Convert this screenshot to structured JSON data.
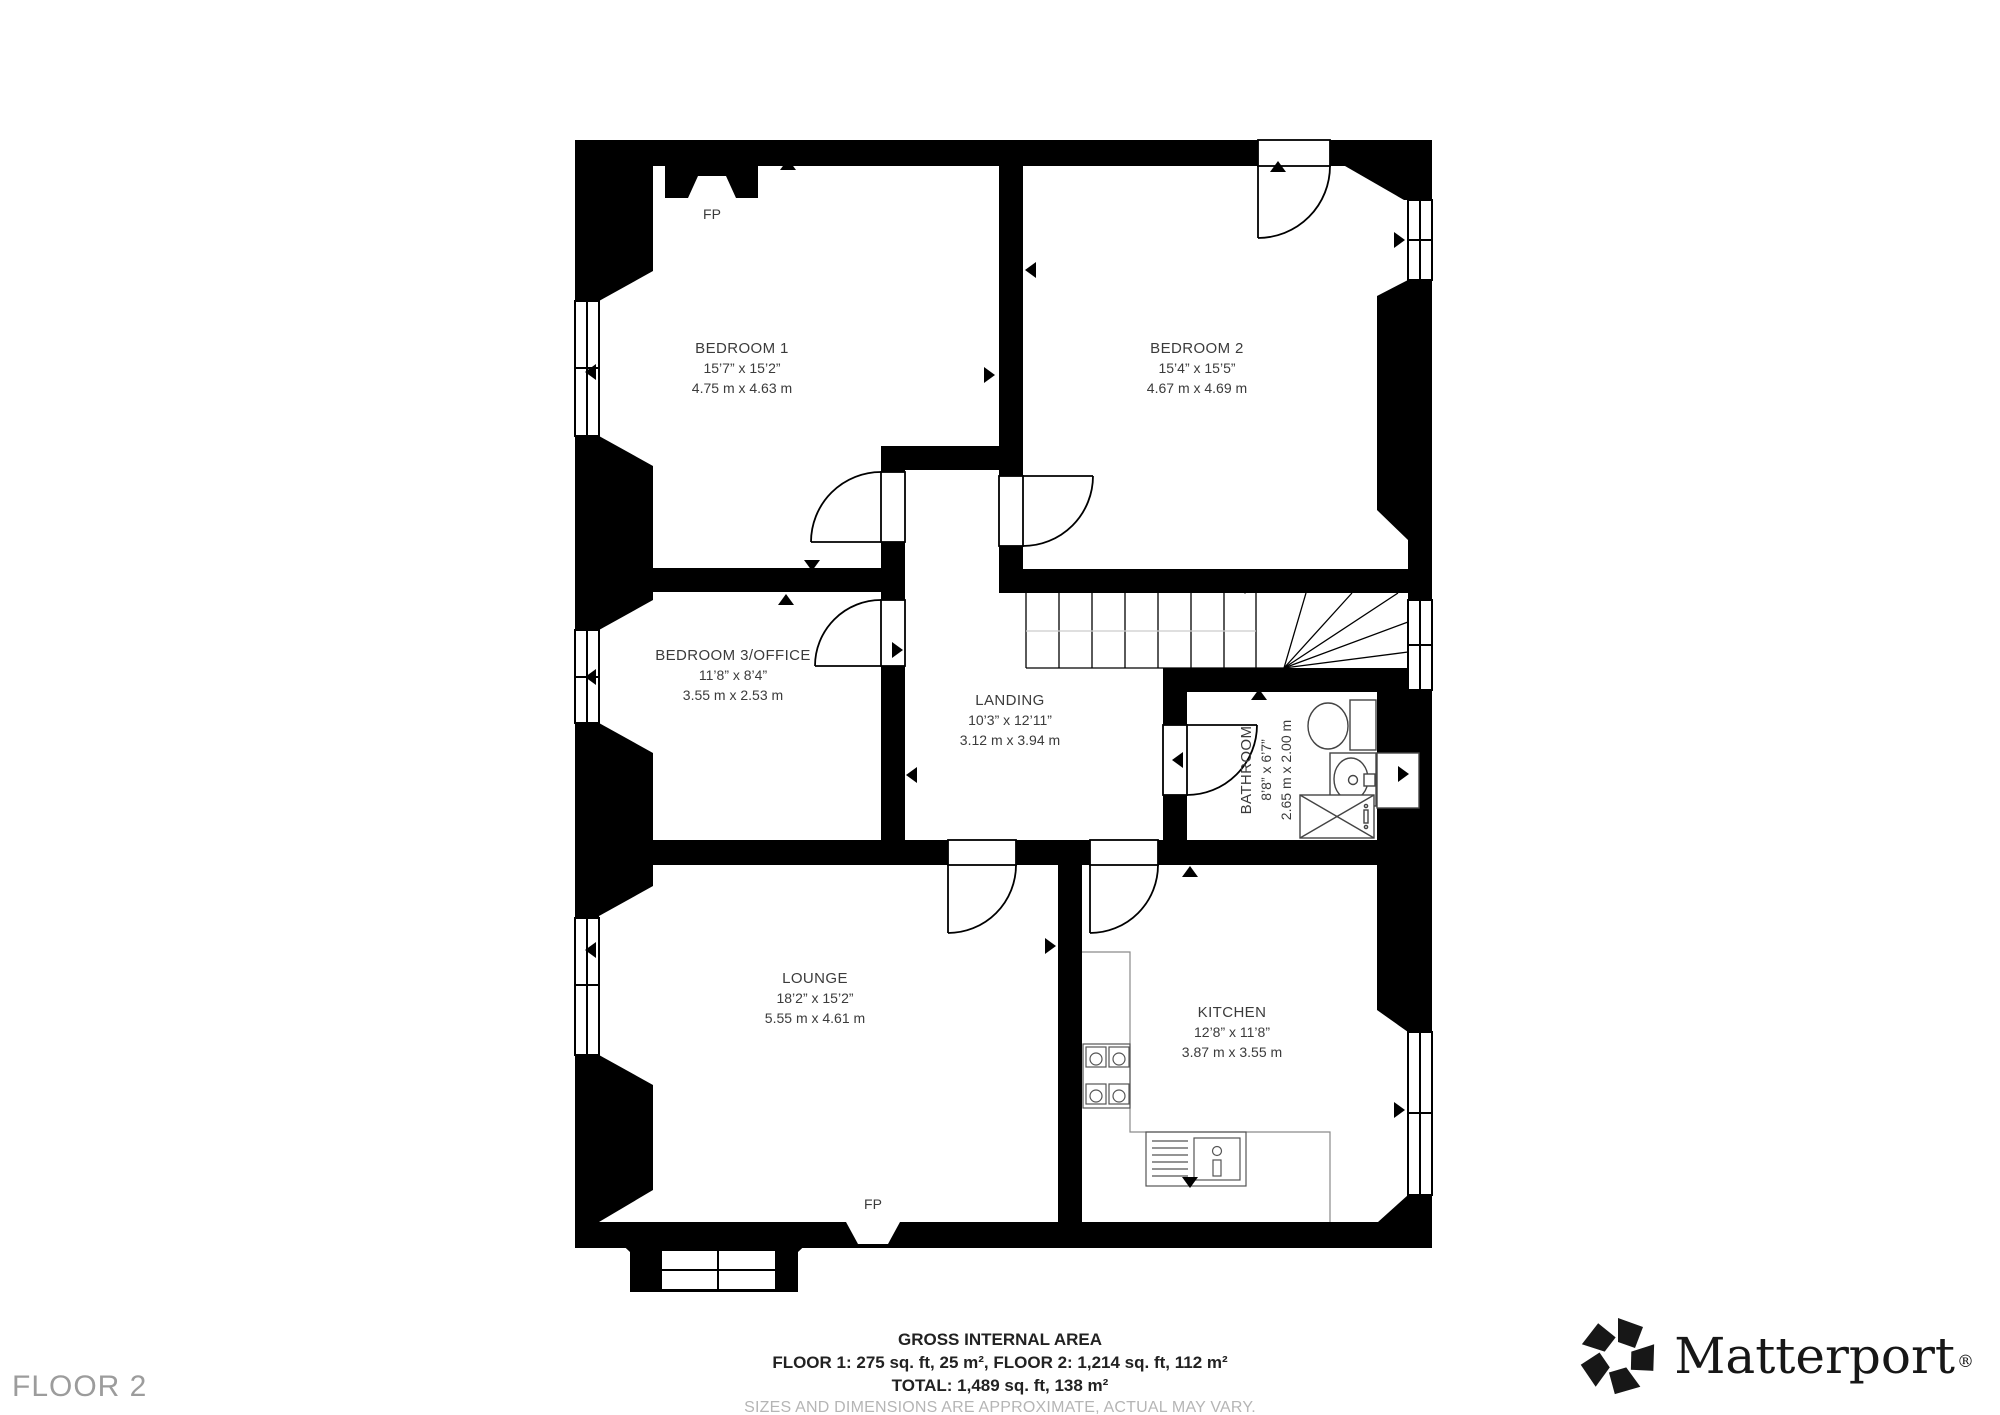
{
  "floor_label": "FLOOR 2",
  "rooms": [
    {
      "id": "bedroom1",
      "name": "BEDROOM 1",
      "imperial": "15’7” x 15’2”",
      "metric": "4.75 m x 4.63 m"
    },
    {
      "id": "bedroom2",
      "name": "BEDROOM 2",
      "imperial": "15’4” x 15’5”",
      "metric": "4.67 m x 4.69 m"
    },
    {
      "id": "bedroom3",
      "name": "BEDROOM 3/OFFICE",
      "imperial": "11’8” x 8’4”",
      "metric": "3.55 m x 2.53 m"
    },
    {
      "id": "landing",
      "name": "LANDING",
      "imperial": "10’3” x 12’11”",
      "metric": "3.12 m x 3.94 m"
    },
    {
      "id": "bathroom",
      "name": "BATHROOM",
      "imperial": "8’8” x 6’7”",
      "metric": "2.65 m x 2.00 m"
    },
    {
      "id": "lounge",
      "name": "LOUNGE",
      "imperial": "18’2” x 15’2”",
      "metric": "5.55 m x 4.61 m"
    },
    {
      "id": "kitchen",
      "name": "KITCHEN",
      "imperial": "12’8” x 11’8”",
      "metric": "3.87 m x 3.55 m"
    }
  ],
  "fireplaces": [
    {
      "label": "FP"
    },
    {
      "label": "FP"
    }
  ],
  "summary": {
    "title": "GROSS INTERNAL AREA",
    "line1": "FLOOR 1: 275 sq. ft, 25 m², FLOOR 2: 1,214 sq. ft, 112 m²",
    "line2": "TOTAL: 1,489 sq. ft, 138 m²",
    "disclaimer": "SIZES AND DIMENSIONS ARE APPROXIMATE, ACTUAL MAY VARY."
  },
  "brand": {
    "name": "Matterport",
    "registered": "®"
  },
  "colors": {
    "wall": "#000000",
    "text": "#3b3b3b",
    "muted": "#9c9c9c",
    "disclaimer": "#b5b5b5"
  }
}
